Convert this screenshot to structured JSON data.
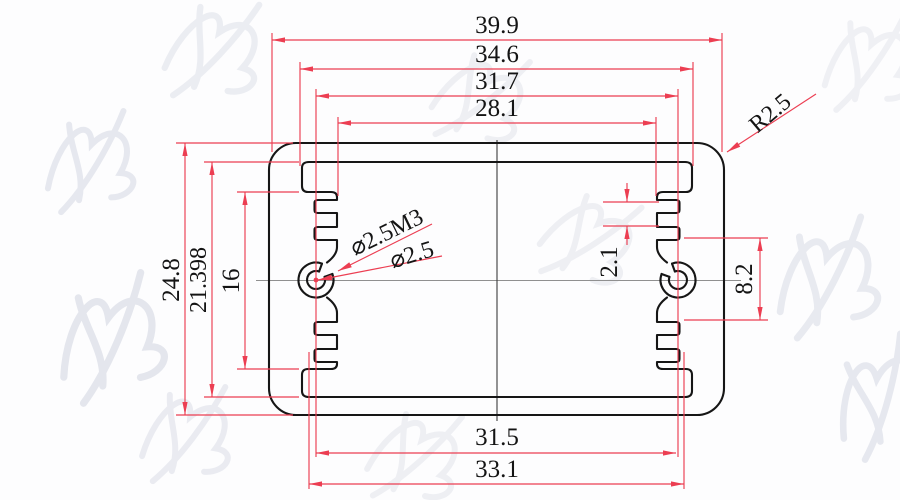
{
  "drawing": {
    "dims_top": [
      {
        "label": "39.9"
      },
      {
        "label": "34.6"
      },
      {
        "label": "31.7"
      },
      {
        "label": "28.1"
      }
    ],
    "dims_left": [
      {
        "label": "24.8"
      },
      {
        "label": "21.398"
      },
      {
        "label": "16"
      }
    ],
    "dims_right": [
      {
        "label": "2.1"
      },
      {
        "label": "8.2"
      }
    ],
    "dims_bottom": [
      {
        "label": "31.5"
      },
      {
        "label": "33.1"
      }
    ],
    "corner_radius": {
      "label": "R2.5"
    },
    "hole_callouts": [
      {
        "label": "⌀2.5M3"
      },
      {
        "label": "⌀2.5"
      }
    ]
  },
  "colors": {
    "dimension_red": "#ec3e52",
    "outline_black": "#161616",
    "centerline_gray": "#909090",
    "paper_background": "#fdfdfe",
    "watermark_gray": "#ccd0dd"
  }
}
